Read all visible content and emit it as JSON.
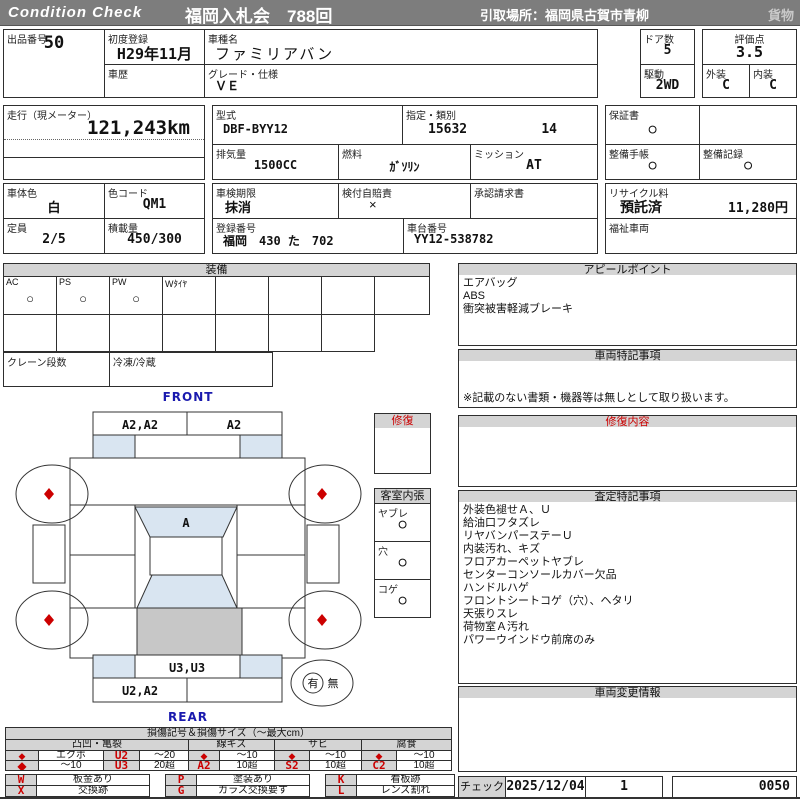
{
  "header": {
    "brand": "Condition  Check",
    "auction": "福岡入札会　788回",
    "pickup": "引取場所：福岡県古賀市青柳",
    "category": "貨物"
  },
  "info": {
    "lot_label": "出品番号",
    "lot": "50",
    "first_reg_label": "初度登録",
    "first_reg": "H29年11月",
    "history_label": "車歴",
    "history": "",
    "model_name_label": "車種名",
    "model_name": "ファミリアバン",
    "grade_label": "グレード・仕様",
    "grade": "ＶＥ",
    "doors_label": "ドア数",
    "doors": "5",
    "drive_label": "駆動",
    "drive": "2WD",
    "score_label": "評価点",
    "score": "3.5",
    "exterior_label": "外装",
    "exterior": "C",
    "interior_label": "内装",
    "interior": "C",
    "mileage_label": "走行（現メーター）",
    "mileage": "121,243km",
    "model_code_label": "型式",
    "model_code": "DBF-BYY12",
    "designation_label": "指定・類別",
    "designation": "15632",
    "classification": "14",
    "displacement_label": "排気量",
    "displacement": "1500CC",
    "fuel_label": "燃料",
    "fuel": "ｶﾞｿﾘﾝ",
    "transmission_label": "ミッション",
    "transmission": "AT",
    "warranty_label": "保証書",
    "warranty": "○",
    "maintenance_book_label": "整備手帳",
    "maintenance_book": "○",
    "maintenance_record_label": "整備記録",
    "maintenance_record": "○",
    "color_label": "車体色",
    "color": "白",
    "color_code_label": "色コード",
    "color_code": "QM1",
    "inspection_label": "車検期限",
    "inspection": "抹消",
    "insurance_label": "検付自賠責",
    "insurance": "×",
    "approval_label": "承認請求書",
    "approval": "",
    "recycle_label": "リサイクル料",
    "recycle_status": "預託済",
    "recycle_fee": "11,280円",
    "capacity_label": "定員",
    "capacity": "2/5",
    "load_label": "積載量",
    "load": "450/300",
    "reg_no_label": "登録番号",
    "reg_no": "福岡　430 た　702",
    "chassis_label": "車台番号",
    "chassis": "YY12-538782",
    "welfare_label": "福祉車両",
    "welfare": ""
  },
  "equipment": {
    "title": "装備",
    "row1": [
      {
        "label": "AC",
        "value": "○"
      },
      {
        "label": "PS",
        "value": "○"
      },
      {
        "label": "PW",
        "value": "○"
      },
      {
        "label": "Wﾀｲﾔ",
        "value": ""
      }
    ],
    "crane_label": "クレーン段数",
    "crane": "",
    "freezer_label": "冷凍/冷蔵",
    "freezer": ""
  },
  "diagram": {
    "front_label": "FRONT",
    "rear_label": "REAR",
    "front_top_left": "A2,A2",
    "front_top_right": "A2",
    "windshield": "A",
    "rear_strip": "U3,U3",
    "rear_bottom_left": "U2,A2",
    "repair_box_title": "修復",
    "lining_title": "客室内張",
    "lining": [
      {
        "label": "ヤブレ",
        "value": "○"
      },
      {
        "label": "穴",
        "value": "○"
      },
      {
        "label": "コゲ",
        "value": "○"
      }
    ],
    "presence_yes": "有",
    "presence_no": "無"
  },
  "panels": {
    "appeal": {
      "title": "アピールポイント",
      "lines": [
        "エアバッグ",
        "ABS",
        "衝突被害軽減ブレーキ"
      ]
    },
    "vehicle_notes": {
      "title": "車両特記事項",
      "note": "※記載のない書類・機器等は無しとして取り扱います。"
    },
    "repair_detail": {
      "title": "修復内容"
    },
    "assessment": {
      "title": "査定特記事項",
      "lines": [
        "外装色褪せＡ、Ｕ",
        "給油口フタズレ",
        "リヤバンパーステーＵ",
        "内装汚れ、キズ",
        "フロアカーペットヤブレ",
        "センターコンソールカバー欠品",
        "ハンドルハゲ",
        "フロントシートコゲ（穴）、ヘタリ",
        "天張りスレ",
        "荷物室Ａ汚れ",
        "パワーウインドウ前席のみ"
      ]
    },
    "change_info": {
      "title": "車両変更情報"
    }
  },
  "legend": {
    "title": "損傷記号＆損傷サイズ（～最大cm）",
    "group_names": [
      "凸凹・亀裂",
      "線キズ",
      "サビ",
      "腐食"
    ],
    "g1": {
      "r1": [
        "◆",
        "エクボ",
        "U2",
        "～20"
      ],
      "r2": [
        "◆",
        "～10",
        "U3",
        "20超"
      ]
    },
    "g2": {
      "r1": [
        "◆",
        "～10"
      ],
      "r2": [
        "A2",
        "10超"
      ]
    },
    "g3": {
      "r1": [
        "◆",
        "～10"
      ],
      "r2": [
        "S2",
        "10超"
      ]
    },
    "g4": {
      "r1": [
        "◆",
        "～10"
      ],
      "r2": [
        "C2",
        "10超"
      ]
    },
    "codes": [
      {
        "code": "W",
        "desc": "板金あり"
      },
      {
        "code": "X",
        "desc": "交換跡"
      },
      {
        "code": "P",
        "desc": "塗装あり"
      },
      {
        "code": "G",
        "desc": "ガラス交換要す"
      },
      {
        "code": "K",
        "desc": "看板跡"
      },
      {
        "code": "L",
        "desc": "レンズ割れ"
      }
    ]
  },
  "footer": {
    "check_label": "チェック",
    "date": "2025/12/04",
    "count": "1",
    "code": "0050"
  },
  "colors": {
    "header_bg": "#7d7d7d",
    "section_bg": "#d4d4d4",
    "accent_red": "#cc0000",
    "label_blue": "#1a1aae",
    "shade_blue": "#d9e5f1",
    "shade_gray": "#c7c7c7"
  }
}
